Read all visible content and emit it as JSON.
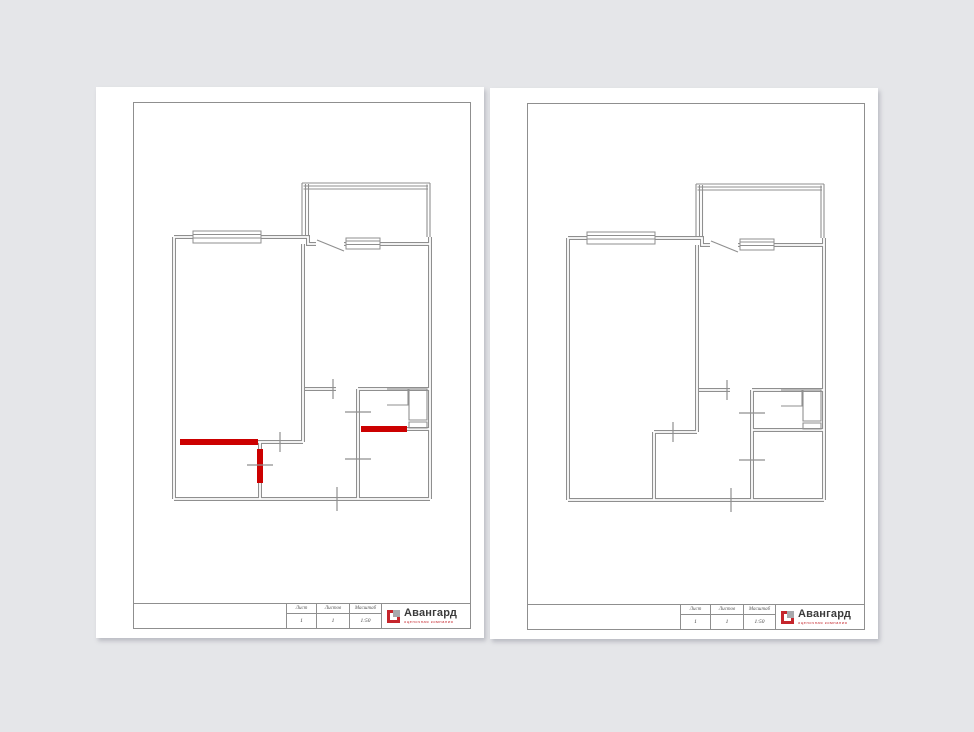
{
  "colors": {
    "background": "#e5e6e9",
    "line": "#8f8f8f",
    "highlight_red": "#cc0000",
    "logo_red": "#c5262c",
    "logo_gray": "#a7a9ac",
    "logo_text": "#3b3b3b"
  },
  "sheets": [
    {
      "name": "floor-plan-with-marked-walls",
      "title_block": {
        "sheet_label": "Лист",
        "sheet_value": "1",
        "sheets_label": "Листов",
        "sheets_value": "1",
        "scale_label": "Масштаб",
        "scale_value": "1:50"
      },
      "logo": {
        "name": "Авангард",
        "subtitle": "оценочная компания"
      }
    },
    {
      "name": "floor-plan-clean",
      "title_block": {
        "sheet_label": "Лист",
        "sheet_value": "1",
        "sheets_label": "Листов",
        "sheets_value": "1",
        "scale_label": "Масштаб",
        "scale_value": "1:50"
      },
      "logo": {
        "name": "Авангард",
        "subtitle": "оценочная компания"
      }
    }
  ]
}
